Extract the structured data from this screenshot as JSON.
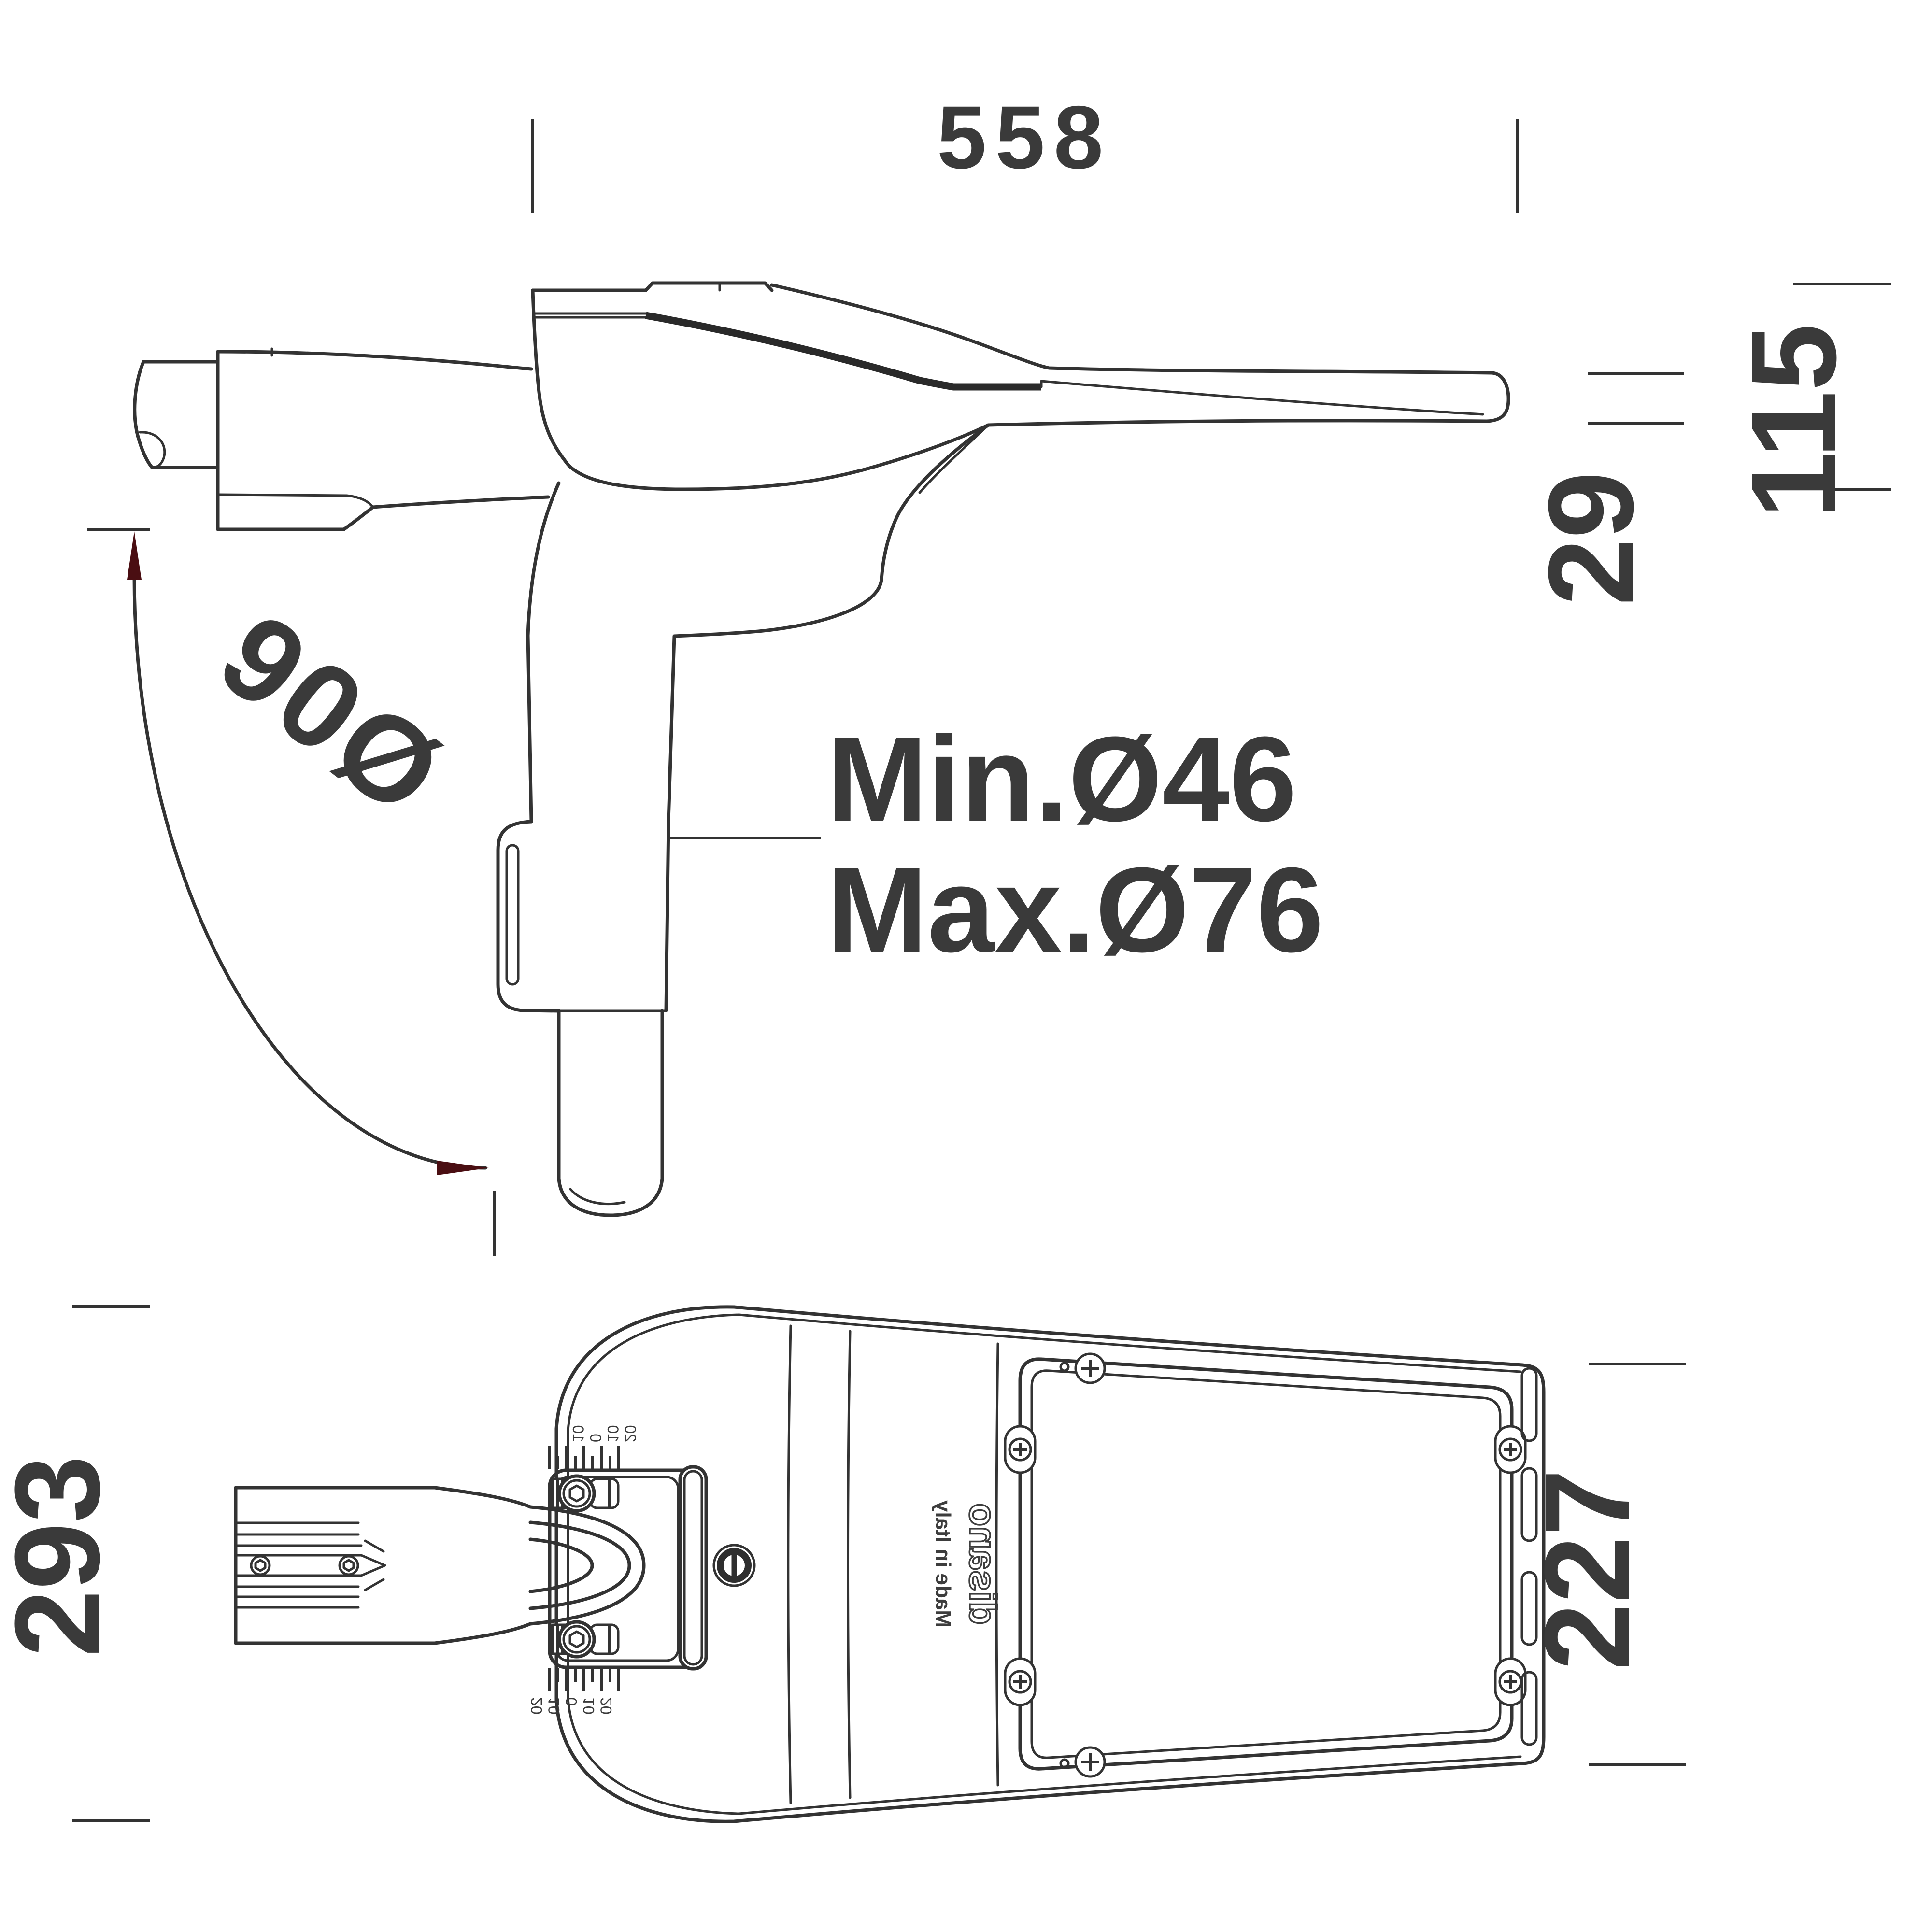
{
  "drawing": {
    "type": "luminaire-dimension-drawing",
    "background_color": "#ffffff",
    "line_color": "#333333",
    "text_color": "#3a3a3a",
    "arrow_color": "#4a0e12",
    "side_view": {
      "width_label": "558",
      "height_label": "115",
      "tail_thickness_label": "29",
      "rotation_label": "90Ø",
      "pole_min_label": "Min.Ø46",
      "pole_max_label": "Max.Ø76"
    },
    "bottom_view": {
      "left_width_label": "293",
      "right_width_label": "227",
      "brand_logo": "disano",
      "origin_label": "Made in Italy",
      "tilt_scale_top": [
        "10",
        "0",
        "10",
        "20"
      ],
      "tilt_scale_bottom": [
        "20",
        "10",
        "0",
        "10",
        "20"
      ]
    }
  }
}
